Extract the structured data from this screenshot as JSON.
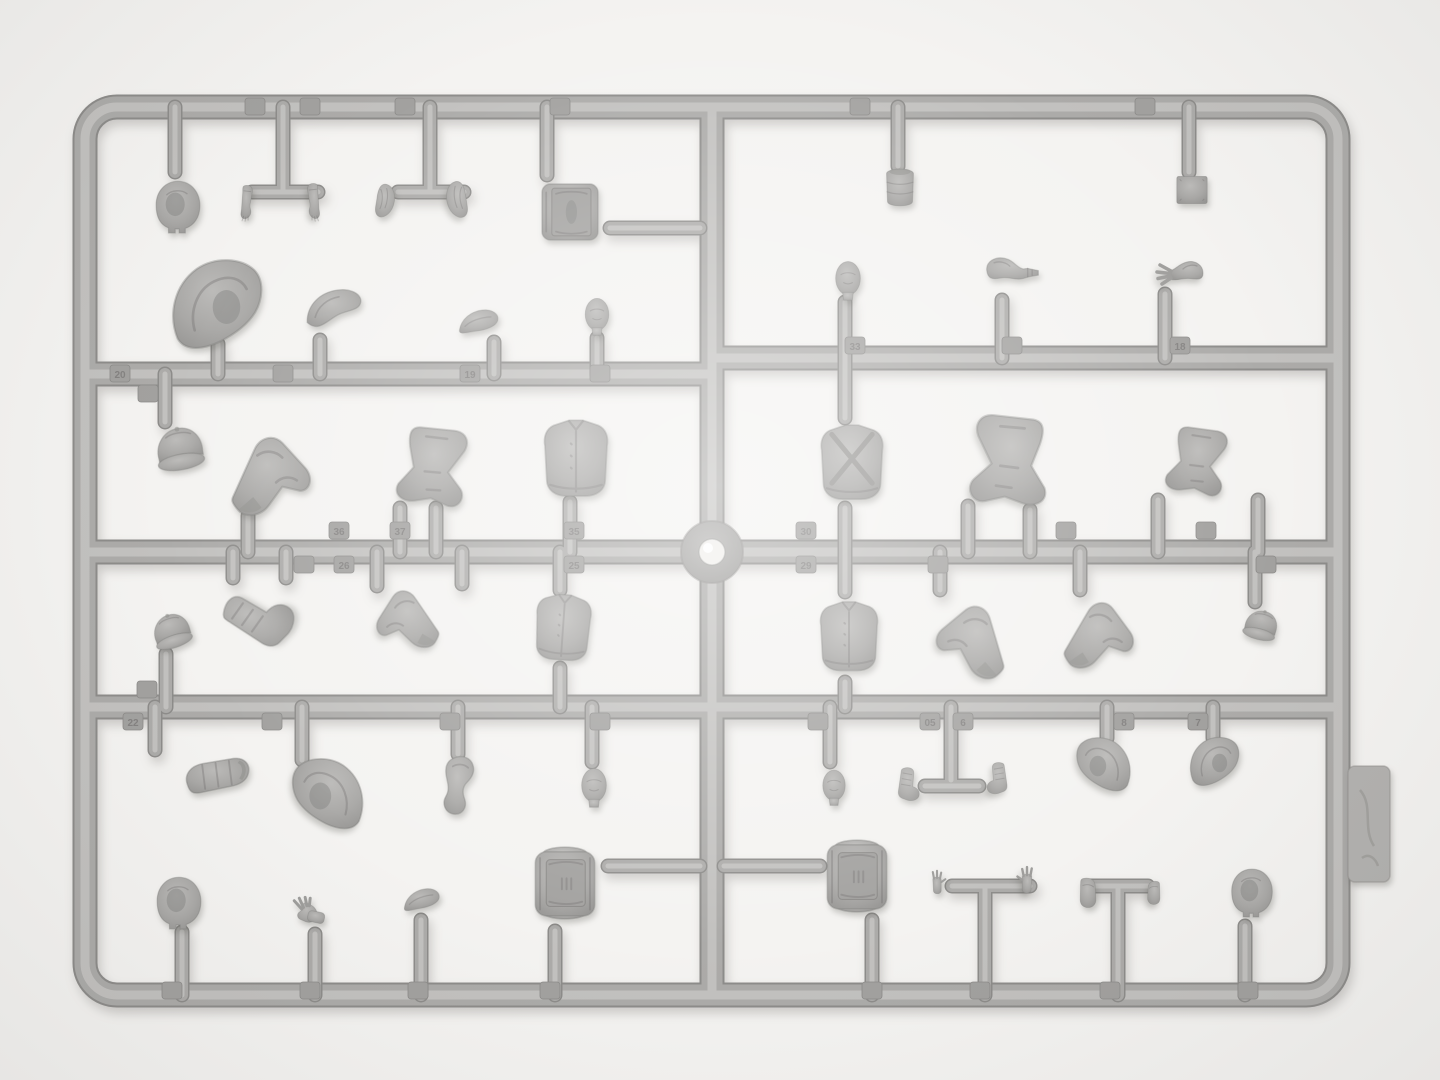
{
  "scene": {
    "description": "Top-down photograph of a gray injection-molded polystyrene model-kit sprue (figure parts: heads, balaclavas, hoods, caps, arms, hands, legs, torsos, backpacks, boxes, canteen) on a white background",
    "background": "#f4f3f1",
    "colors": {
      "plastic_base": "#a9a8a6",
      "plastic_dark": "#8d8c8a",
      "plastic_mid": "#acaba9",
      "plastic_light": "#c2c1bf",
      "chip": "#a2a19f",
      "gate_shine": "#f0efec",
      "shadow": "rgba(90,88,84,0.28)"
    },
    "counts": {
      "parts": 49,
      "number_tabs": 43
    }
  },
  "sprue": {
    "frame_path": "M117,107 L1306,107 A32,32 0 0 1 1338,139 L1338,963 A32,32 0 0 1 1306,995 L117,995 A32,32 0 0 1 85,963 L85,139 A32,32 0 0 1 117,107 Z",
    "rails": [
      "M712,107 L712,995",
      "M85,374 L712,374",
      "M712,358 L1338,358",
      "M85,552 L1338,552",
      "M85,707 L1338,707"
    ],
    "gates": [
      [
        175,
        107,
        175,
        172
      ],
      [
        283,
        107,
        283,
        192
      ],
      [
        252,
        192,
        318,
        192
      ],
      [
        430,
        107,
        430,
        192
      ],
      [
        398,
        192,
        464,
        192
      ],
      [
        547,
        107,
        547,
        175
      ],
      [
        898,
        107,
        898,
        166
      ],
      [
        1189,
        107,
        1189,
        172
      ],
      [
        218,
        344,
        218,
        374
      ],
      [
        320,
        340,
        320,
        374
      ],
      [
        494,
        342,
        494,
        374
      ],
      [
        597,
        338,
        597,
        374
      ],
      [
        845,
        302,
        845,
        358
      ],
      [
        1002,
        300,
        1002,
        358
      ],
      [
        1165,
        294,
        1165,
        358
      ],
      [
        165,
        374,
        165,
        422
      ],
      [
        248,
        516,
        248,
        552
      ],
      [
        400,
        508,
        400,
        552
      ],
      [
        436,
        508,
        436,
        552
      ],
      [
        570,
        502,
        570,
        552
      ],
      [
        845,
        358,
        845,
        418
      ],
      [
        845,
        508,
        845,
        552
      ],
      [
        968,
        506,
        968,
        552
      ],
      [
        1030,
        510,
        1030,
        552
      ],
      [
        1158,
        500,
        1158,
        552
      ],
      [
        1258,
        500,
        1258,
        552
      ],
      [
        166,
        654,
        166,
        707
      ],
      [
        233,
        552,
        233,
        578
      ],
      [
        286,
        552,
        286,
        578
      ],
      [
        377,
        552,
        377,
        586
      ],
      [
        462,
        552,
        462,
        584
      ],
      [
        560,
        552,
        560,
        590
      ],
      [
        560,
        668,
        560,
        707
      ],
      [
        845,
        552,
        845,
        592
      ],
      [
        845,
        682,
        845,
        707
      ],
      [
        940,
        552,
        940,
        590
      ],
      [
        1080,
        552,
        1080,
        590
      ],
      [
        1255,
        552,
        1255,
        602
      ],
      [
        155,
        707,
        155,
        750
      ],
      [
        302,
        707,
        302,
        760
      ],
      [
        458,
        707,
        458,
        754
      ],
      [
        592,
        707,
        592,
        762
      ],
      [
        830,
        707,
        830,
        762
      ],
      [
        951,
        707,
        951,
        780
      ],
      [
        925,
        786,
        979,
        786
      ],
      [
        1107,
        707,
        1107,
        738
      ],
      [
        1213,
        707,
        1213,
        738
      ],
      [
        182,
        932,
        182,
        995
      ],
      [
        315,
        934,
        315,
        995
      ],
      [
        421,
        920,
        421,
        995
      ],
      [
        555,
        931,
        555,
        995
      ],
      [
        872,
        920,
        872,
        995
      ],
      [
        985,
        886,
        985,
        995
      ],
      [
        952,
        886,
        1030,
        886
      ],
      [
        1118,
        886,
        1118,
        995
      ],
      [
        1088,
        886,
        1148,
        886
      ],
      [
        1245,
        926,
        1245,
        995
      ],
      [
        610,
        228,
        700,
        228
      ],
      [
        608,
        866,
        700,
        866
      ],
      [
        724,
        866,
        820,
        866
      ]
    ],
    "gate_mark": {
      "cx": 712,
      "cy": 552,
      "outer_r": 31,
      "inner_r": 13
    },
    "brand_tab": {
      "x": 1348,
      "y": 766,
      "w": 42,
      "h": 116
    }
  },
  "chips": [
    {
      "x": 255,
      "y": 107,
      "n": ""
    },
    {
      "x": 310,
      "y": 107,
      "n": ""
    },
    {
      "x": 405,
      "y": 107,
      "n": ""
    },
    {
      "x": 560,
      "y": 107,
      "n": ""
    },
    {
      "x": 860,
      "y": 107,
      "n": ""
    },
    {
      "x": 1145,
      "y": 107,
      "n": ""
    },
    {
      "x": 120,
      "y": 374,
      "n": "20"
    },
    {
      "x": 283,
      "y": 374,
      "n": ""
    },
    {
      "x": 470,
      "y": 374,
      "n": "19"
    },
    {
      "x": 600,
      "y": 374,
      "n": ""
    },
    {
      "x": 855,
      "y": 346,
      "n": "33"
    },
    {
      "x": 1012,
      "y": 346,
      "n": ""
    },
    {
      "x": 1180,
      "y": 346,
      "n": "18"
    },
    {
      "x": 148,
      "y": 394,
      "n": ""
    },
    {
      "x": 147,
      "y": 690,
      "n": ""
    },
    {
      "x": 339,
      "y": 531,
      "n": "36"
    },
    {
      "x": 400,
      "y": 531,
      "n": "37"
    },
    {
      "x": 574,
      "y": 531,
      "n": "35"
    },
    {
      "x": 806,
      "y": 531,
      "n": "30"
    },
    {
      "x": 1066,
      "y": 531,
      "n": ""
    },
    {
      "x": 1206,
      "y": 531,
      "n": ""
    },
    {
      "x": 304,
      "y": 565,
      "n": ""
    },
    {
      "x": 344,
      "y": 565,
      "n": "26"
    },
    {
      "x": 574,
      "y": 565,
      "n": "25"
    },
    {
      "x": 806,
      "y": 565,
      "n": "29"
    },
    {
      "x": 938,
      "y": 565,
      "n": ""
    },
    {
      "x": 1266,
      "y": 565,
      "n": ""
    },
    {
      "x": 133,
      "y": 722,
      "n": "22"
    },
    {
      "x": 272,
      "y": 722,
      "n": ""
    },
    {
      "x": 450,
      "y": 722,
      "n": ""
    },
    {
      "x": 600,
      "y": 722,
      "n": ""
    },
    {
      "x": 818,
      "y": 722,
      "n": ""
    },
    {
      "x": 930,
      "y": 722,
      "n": "05"
    },
    {
      "x": 963,
      "y": 722,
      "n": "6"
    },
    {
      "x": 1124,
      "y": 722,
      "n": "8"
    },
    {
      "x": 1198,
      "y": 722,
      "n": "7"
    },
    {
      "x": 172,
      "y": 991,
      "n": ""
    },
    {
      "x": 310,
      "y": 991,
      "n": ""
    },
    {
      "x": 418,
      "y": 991,
      "n": ""
    },
    {
      "x": 550,
      "y": 991,
      "n": ""
    },
    {
      "x": 872,
      "y": 991,
      "n": ""
    },
    {
      "x": 980,
      "y": 991,
      "n": ""
    },
    {
      "x": 1110,
      "y": 991,
      "n": ""
    },
    {
      "x": 1248,
      "y": 991,
      "n": ""
    }
  ],
  "parts": [
    {
      "name": "balaclava-head-1",
      "shape": "balaclava",
      "x": 150,
      "y": 174,
      "w": 56,
      "h": 64,
      "rot": 0,
      "flip": false
    },
    {
      "name": "forearm-hand-left",
      "shape": "forearm",
      "x": 231,
      "y": 168,
      "w": 38,
      "h": 70,
      "rot": 0,
      "flip": false
    },
    {
      "name": "forearm-hand-right",
      "shape": "forearm",
      "x": 290,
      "y": 166,
      "w": 40,
      "h": 72,
      "rot": 0,
      "flip": true
    },
    {
      "name": "sleeve-pouch-left",
      "shape": "pouch",
      "x": 364,
      "y": 172,
      "w": 42,
      "h": 60,
      "rot": 0,
      "flip": false
    },
    {
      "name": "sleeve-pouch-right",
      "shape": "pouch",
      "x": 434,
      "y": 170,
      "w": 46,
      "h": 62,
      "rot": 0,
      "flip": true
    },
    {
      "name": "supply-box",
      "shape": "box",
      "x": 535,
      "y": 173,
      "w": 70,
      "h": 78,
      "rot": 0,
      "flip": false
    },
    {
      "name": "large-hood",
      "shape": "hood",
      "x": 146,
      "y": 254,
      "w": 144,
      "h": 106,
      "rot": 0,
      "flip": false
    },
    {
      "name": "collar-hood-piece",
      "shape": "collar",
      "x": 289,
      "y": 279,
      "w": 92,
      "h": 66,
      "rot": 0,
      "flip": false
    },
    {
      "name": "visor-cap",
      "shape": "lens",
      "x": 435,
      "y": 298,
      "w": 88,
      "h": 48,
      "rot": -6,
      "flip": false
    },
    {
      "name": "head-1",
      "shape": "head",
      "x": 576,
      "y": 290,
      "w": 42,
      "h": 52,
      "rot": 0,
      "flip": false
    },
    {
      "name": "canteen",
      "shape": "canteen",
      "x": 874,
      "y": 164,
      "w": 52,
      "h": 48,
      "rot": 0,
      "flip": false
    },
    {
      "name": "flat-plate",
      "shape": "plate",
      "x": 1168,
      "y": 170,
      "w": 48,
      "h": 40,
      "rot": 0,
      "flip": false
    },
    {
      "name": "head-2",
      "shape": "head",
      "x": 826,
      "y": 254,
      "w": 44,
      "h": 52,
      "rot": 0,
      "flip": false
    },
    {
      "name": "arm-with-pistol",
      "shape": "armpistol",
      "x": 956,
      "y": 246,
      "w": 112,
      "h": 56,
      "rot": 0,
      "flip": false
    },
    {
      "name": "arm-open-hand",
      "shape": "armopen",
      "x": 1120,
      "y": 250,
      "w": 120,
      "h": 50,
      "rot": 0,
      "flip": true
    },
    {
      "name": "field-cap-1",
      "shape": "cap",
      "x": 148,
      "y": 420,
      "w": 64,
      "h": 60,
      "rot": -10,
      "flip": false
    },
    {
      "name": "bent-leg-1",
      "shape": "legbent",
      "x": 214,
      "y": 418,
      "w": 120,
      "h": 104,
      "rot": 0,
      "flip": false
    },
    {
      "name": "legs-pair-1",
      "shape": "legspair",
      "x": 384,
      "y": 416,
      "w": 104,
      "h": 96,
      "rot": 12,
      "flip": false
    },
    {
      "name": "torso-1",
      "shape": "torso",
      "x": 531,
      "y": 416,
      "w": 90,
      "h": 86,
      "rot": 0,
      "flip": false
    },
    {
      "name": "torso-cross-straps",
      "shape": "torsostraps",
      "x": 810,
      "y": 416,
      "w": 84,
      "h": 94,
      "rot": 0,
      "flip": false
    },
    {
      "name": "legs-pair-2",
      "shape": "legspair",
      "x": 948,
      "y": 402,
      "w": 118,
      "h": 110,
      "rot": 0,
      "flip": true
    },
    {
      "name": "legs-pair-3",
      "shape": "legspair",
      "x": 1126,
      "y": 418,
      "w": 148,
      "h": 82,
      "rot": 14,
      "flip": false
    },
    {
      "name": "field-cap-2",
      "shape": "cap",
      "x": 146,
      "y": 608,
      "w": 52,
      "h": 48,
      "rot": -18,
      "flip": false
    },
    {
      "name": "boot-shoe",
      "shape": "bootupper",
      "x": 213,
      "y": 572,
      "w": 98,
      "h": 84,
      "rot": -65,
      "flip": false
    },
    {
      "name": "lying-leg",
      "shape": "legbent",
      "x": 336,
      "y": 576,
      "w": 134,
      "h": 80,
      "rot": 10,
      "flip": true
    },
    {
      "name": "torso-2",
      "shape": "torso",
      "x": 526,
      "y": 586,
      "w": 74,
      "h": 84,
      "rot": 4,
      "flip": false
    },
    {
      "name": "torso-buttons",
      "shape": "torso",
      "x": 810,
      "y": 590,
      "w": 78,
      "h": 94,
      "rot": 0,
      "flip": false
    },
    {
      "name": "bent-leg-2",
      "shape": "legbent",
      "x": 923,
      "y": 586,
      "w": 94,
      "h": 98,
      "rot": -8,
      "flip": true
    },
    {
      "name": "bent-leg-3",
      "shape": "legbent",
      "x": 1053,
      "y": 586,
      "w": 100,
      "h": 90,
      "rot": 6,
      "flip": false
    },
    {
      "name": "field-cap-3",
      "shape": "cap",
      "x": 1240,
      "y": 600,
      "w": 42,
      "h": 52,
      "rot": 14,
      "flip": false
    },
    {
      "name": "coat-roll",
      "shape": "roll",
      "x": 131,
      "y": 743,
      "w": 172,
      "h": 74,
      "rot": 0,
      "flip": false
    },
    {
      "name": "hood-2",
      "shape": "hood",
      "x": 276,
      "y": 754,
      "w": 102,
      "h": 84,
      "rot": 0,
      "flip": true
    },
    {
      "name": "mitt-arm",
      "shape": "mitt",
      "x": 436,
      "y": 750,
      "w": 70,
      "h": 72,
      "rot": 0,
      "flip": false
    },
    {
      "name": "head-3",
      "shape": "head",
      "x": 572,
      "y": 760,
      "w": 44,
      "h": 54,
      "rot": 0,
      "flip": false
    },
    {
      "name": "head-4",
      "shape": "head",
      "x": 814,
      "y": 758,
      "w": 40,
      "h": 58,
      "rot": 0,
      "flip": false
    },
    {
      "name": "boot-upper-left",
      "shape": "bootupper",
      "x": 891,
      "y": 743,
      "w": 40,
      "h": 84,
      "rot": 0,
      "flip": false
    },
    {
      "name": "boot-upper-right",
      "shape": "bootupper",
      "x": 976,
      "y": 738,
      "w": 38,
      "h": 82,
      "rot": 0,
      "flip": true
    },
    {
      "name": "hood-3",
      "shape": "hood",
      "x": 1060,
      "y": 734,
      "w": 86,
      "h": 64,
      "rot": 0,
      "flip": true
    },
    {
      "name": "hood-4",
      "shape": "hood",
      "x": 1172,
      "y": 734,
      "w": 86,
      "h": 58,
      "rot": 0,
      "flip": false
    },
    {
      "name": "balaclava-head-2",
      "shape": "balaclava",
      "x": 151,
      "y": 870,
      "w": 56,
      "h": 64,
      "rot": 0,
      "flip": false
    },
    {
      "name": "glove-hand",
      "shape": "glove",
      "x": 270,
      "y": 894,
      "w": 72,
      "h": 42,
      "rot": 0,
      "flip": false
    },
    {
      "name": "crown-pad",
      "shape": "lens",
      "x": 391,
      "y": 878,
      "w": 62,
      "h": 44,
      "rot": -8,
      "flip": false
    },
    {
      "name": "backpack-1",
      "shape": "backpack",
      "x": 526,
      "y": 833,
      "w": 78,
      "h": 100,
      "rot": 0,
      "flip": false
    },
    {
      "name": "backpack-2",
      "shape": "backpack",
      "x": 818,
      "y": 830,
      "w": 78,
      "h": 92,
      "rot": 0,
      "flip": false
    },
    {
      "name": "raised-hand-left",
      "shape": "handup",
      "x": 922,
      "y": 852,
      "w": 30,
      "h": 64,
      "rot": 0,
      "flip": false
    },
    {
      "name": "raised-hand-right",
      "shape": "handup",
      "x": 1010,
      "y": 848,
      "w": 34,
      "h": 68,
      "rot": 0,
      "flip": true
    },
    {
      "name": "cuff-piece-1",
      "shape": "smallpouch",
      "x": 1070,
      "y": 866,
      "w": 38,
      "h": 54,
      "rot": 0,
      "flip": false
    },
    {
      "name": "cuff-piece-2",
      "shape": "smallpouch",
      "x": 1138,
      "y": 866,
      "w": 30,
      "h": 54,
      "rot": 0,
      "flip": true
    },
    {
      "name": "balaclava-head-3",
      "shape": "balaclava",
      "x": 1226,
      "y": 856,
      "w": 52,
      "h": 72,
      "rot": 0,
      "flip": false
    }
  ]
}
